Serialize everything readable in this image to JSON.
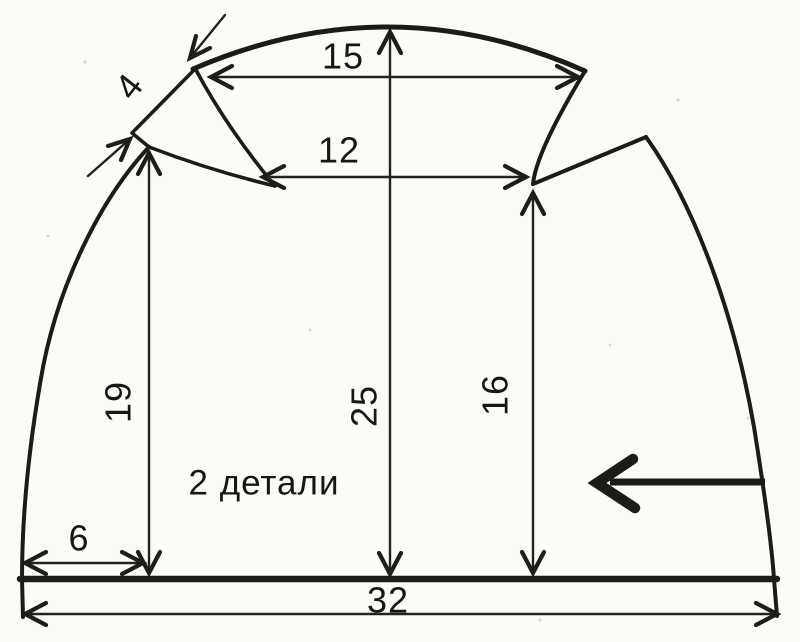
{
  "diagram": {
    "piece_note": "2 детали",
    "dimensions": {
      "crown_width": "15",
      "dart_span": "12",
      "dart_edge": "4",
      "left_height": "19",
      "center_height": "25",
      "right_height": "16",
      "left_offset": "6",
      "bottom_width": "32"
    },
    "colors": {
      "ink": "#1b1b19",
      "paper": "#fbfbf8"
    }
  }
}
